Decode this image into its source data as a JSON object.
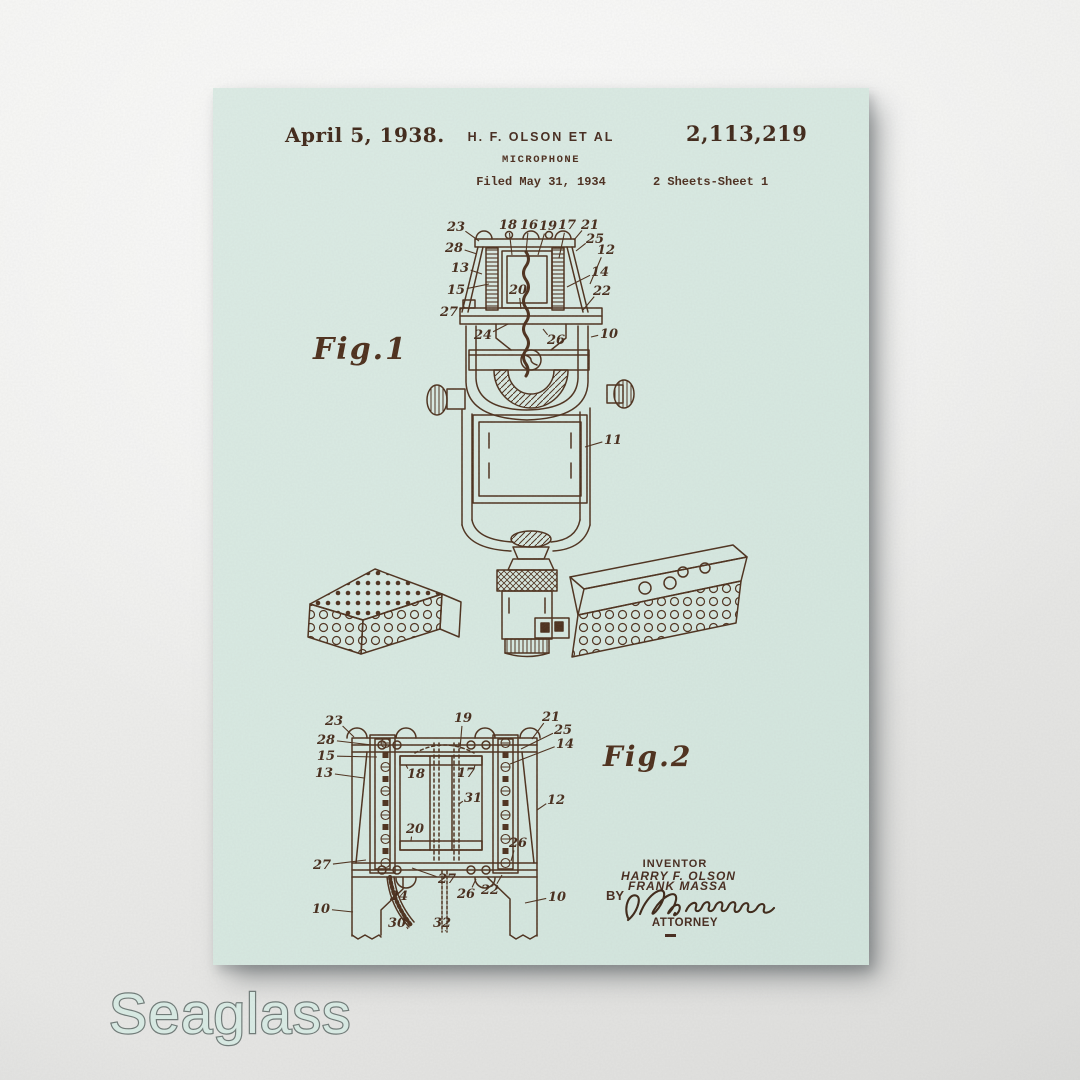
{
  "brand": {
    "label": "Seaglass"
  },
  "colors": {
    "poster_background": "#d7e9e1",
    "ink": "#4a2d19",
    "wall": "#ededeb",
    "brand_fill": "#d9ece5",
    "brand_stroke": "#6d7875"
  },
  "patent": {
    "date": "April 5, 1938.",
    "applicant": "H. F. OLSON ET AL",
    "number": "2,113,219",
    "title": "MICROPHONE",
    "filed": "Filed May 31, 1934",
    "sheets": "2 Sheets-Sheet 1",
    "fig1_label": "Fig.1",
    "fig2_label": "Fig.2",
    "inventor_heading": "INVENTOR",
    "inventor_names": [
      "HARRY F. OLSON",
      "FRANK MASSA"
    ],
    "by_label": "BY",
    "attorney_label": "ATTORNEY",
    "fig1_callouts": [
      {
        "n": "23",
        "tx": 243,
        "ty": 139,
        "lx": 266,
        "ly": 153
      },
      {
        "n": "18",
        "tx": 295,
        "ty": 137,
        "lx": 299,
        "ly": 167
      },
      {
        "n": "16",
        "tx": 316,
        "ty": 137,
        "lx": 313,
        "ly": 165
      },
      {
        "n": "19",
        "tx": 335,
        "ty": 138,
        "lx": 325,
        "ly": 167
      },
      {
        "n": "17",
        "tx": 354,
        "ty": 137,
        "lx": 346,
        "ly": 170
      },
      {
        "n": "21",
        "tx": 377,
        "ty": 137,
        "lx": 361,
        "ly": 152
      },
      {
        "n": "28",
        "tx": 241,
        "ty": 160,
        "lx": 264,
        "ly": 166
      },
      {
        "n": "25",
        "tx": 382,
        "ty": 151,
        "lx": 363,
        "ly": 163
      },
      {
        "n": "12",
        "tx": 393,
        "ty": 162,
        "lx": 377,
        "ly": 196
      },
      {
        "n": "13",
        "tx": 247,
        "ty": 180,
        "lx": 269,
        "ly": 186
      },
      {
        "n": "14",
        "tx": 387,
        "ty": 184,
        "lx": 354,
        "ly": 199
      },
      {
        "n": "15",
        "tx": 243,
        "ty": 202,
        "lx": 276,
        "ly": 196
      },
      {
        "n": "20",
        "tx": 305,
        "ty": 202,
        "lx": 308,
        "ly": 221
      },
      {
        "n": "22",
        "tx": 389,
        "ty": 203,
        "lx": 370,
        "ly": 222
      },
      {
        "n": "27",
        "tx": 236,
        "ty": 224,
        "lx": 252,
        "ly": 219
      },
      {
        "n": "24",
        "tx": 270,
        "ty": 247,
        "lx": 295,
        "ly": 236
      },
      {
        "n": "26",
        "tx": 343,
        "ty": 252,
        "lx": 330,
        "ly": 241
      },
      {
        "n": "10",
        "tx": 396,
        "ty": 246,
        "lx": 378,
        "ly": 249
      },
      {
        "n": "11",
        "tx": 400,
        "ty": 352,
        "lx": 372,
        "ly": 359
      }
    ],
    "fig2_callouts": [
      {
        "n": "23",
        "tx": 121,
        "ty": 633,
        "lx": 141,
        "ly": 649
      },
      {
        "n": "28",
        "tx": 113,
        "ty": 652,
        "lx": 159,
        "ly": 657
      },
      {
        "n": "15",
        "tx": 113,
        "ty": 668,
        "lx": 164,
        "ly": 669
      },
      {
        "n": "13",
        "tx": 111,
        "ty": 685,
        "lx": 151,
        "ly": 690
      },
      {
        "n": "27",
        "tx": 109,
        "ty": 777,
        "lx": 153,
        "ly": 772
      },
      {
        "n": "10",
        "tx": 108,
        "ty": 821,
        "lx": 140,
        "ly": 824
      },
      {
        "n": "19",
        "tx": 250,
        "ty": 630,
        "lx": 247,
        "ly": 661
      },
      {
        "n": "21",
        "tx": 338,
        "ty": 629,
        "lx": 319,
        "ly": 651
      },
      {
        "n": "25",
        "tx": 350,
        "ty": 642,
        "lx": 308,
        "ly": 661
      },
      {
        "n": "14",
        "tx": 352,
        "ty": 656,
        "lx": 297,
        "ly": 676
      },
      {
        "n": "12",
        "tx": 343,
        "ty": 712,
        "lx": 324,
        "ly": 722
      },
      {
        "n": "26",
        "tx": 305,
        "ty": 755,
        "lx": 298,
        "ly": 773
      },
      {
        "n": "22",
        "tx": 277,
        "ty": 802,
        "lx": 289,
        "ly": 787
      },
      {
        "n": "27",
        "tx": 234,
        "ty": 791,
        "lx": 199,
        "ly": 780
      },
      {
        "n": "26",
        "tx": 253,
        "ty": 806,
        "lx": 263,
        "ly": 791
      },
      {
        "n": "24",
        "tx": 186,
        "ty": 808,
        "lx": 176,
        "ly": 791
      },
      {
        "n": "30",
        "tx": 184,
        "ty": 835,
        "lx": 195,
        "ly": 841
      },
      {
        "n": "32",
        "tx": 229,
        "ty": 835,
        "lx": 232,
        "ly": 843
      },
      {
        "n": "10",
        "tx": 344,
        "ty": 809,
        "lx": 312,
        "ly": 815
      },
      {
        "n": "18",
        "tx": 203,
        "ty": 686,
        "lx": 193,
        "ly": 677
      },
      {
        "n": "17",
        "tx": 253,
        "ty": 685,
        "lx": 262,
        "ly": 677
      },
      {
        "n": "31",
        "tx": 260,
        "ty": 710,
        "lx": 246,
        "ly": 716
      },
      {
        "n": "20",
        "tx": 202,
        "ty": 741,
        "lx": 198,
        "ly": 753
      }
    ]
  }
}
